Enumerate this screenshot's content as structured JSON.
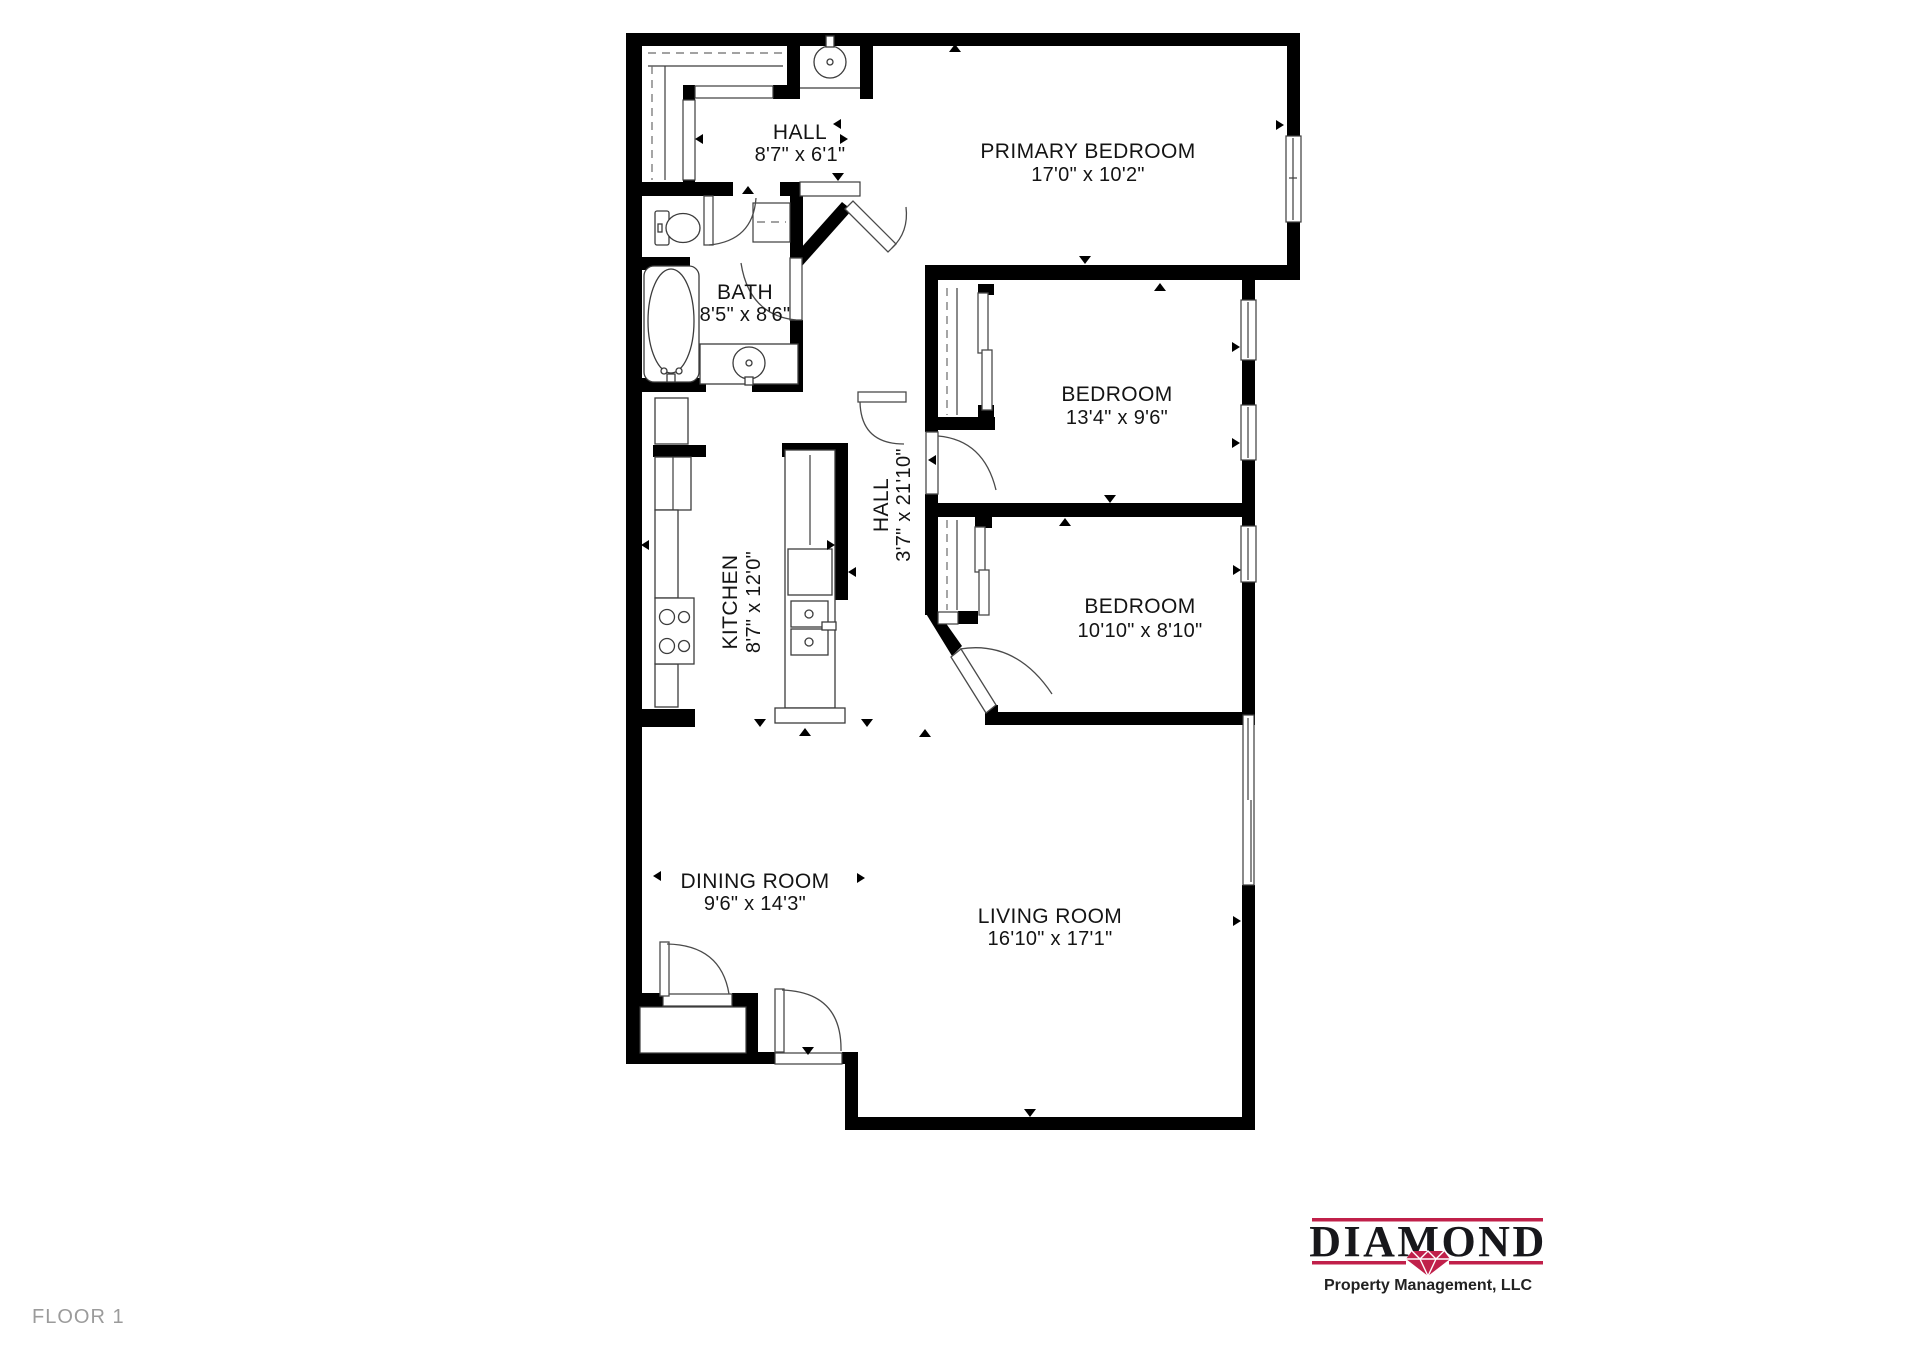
{
  "floor": {
    "label": "FLOOR 1"
  },
  "logo": {
    "name": "DIAMOND",
    "tagline": "Property Management, LLC",
    "accent_color": "#c0204a",
    "text_color": "#17171b"
  },
  "colors": {
    "wall": "#000000",
    "label": "#141414",
    "floor_label": "#9b9b9b"
  },
  "rooms": [
    {
      "name": "HALL",
      "dims": "8'7\" x 6'1\""
    },
    {
      "name": "PRIMARY BEDROOM",
      "dims": "17'0\" x 10'2\""
    },
    {
      "name": "BATH",
      "dims": "8'5\" x 8'6\""
    },
    {
      "name": "BEDROOM",
      "dims": "13'4\" x 9'6\""
    },
    {
      "name": "HALL",
      "dims": "3'7\" x 21'10\""
    },
    {
      "name": "KITCHEN",
      "dims": "8'7\" x 12'0\""
    },
    {
      "name": "BEDROOM",
      "dims": "10'10\" x 8'10\""
    },
    {
      "name": "DINING ROOM",
      "dims": "9'6\" x 14'3\""
    },
    {
      "name": "LIVING ROOM",
      "dims": "16'10\" x 17'1\""
    }
  ]
}
